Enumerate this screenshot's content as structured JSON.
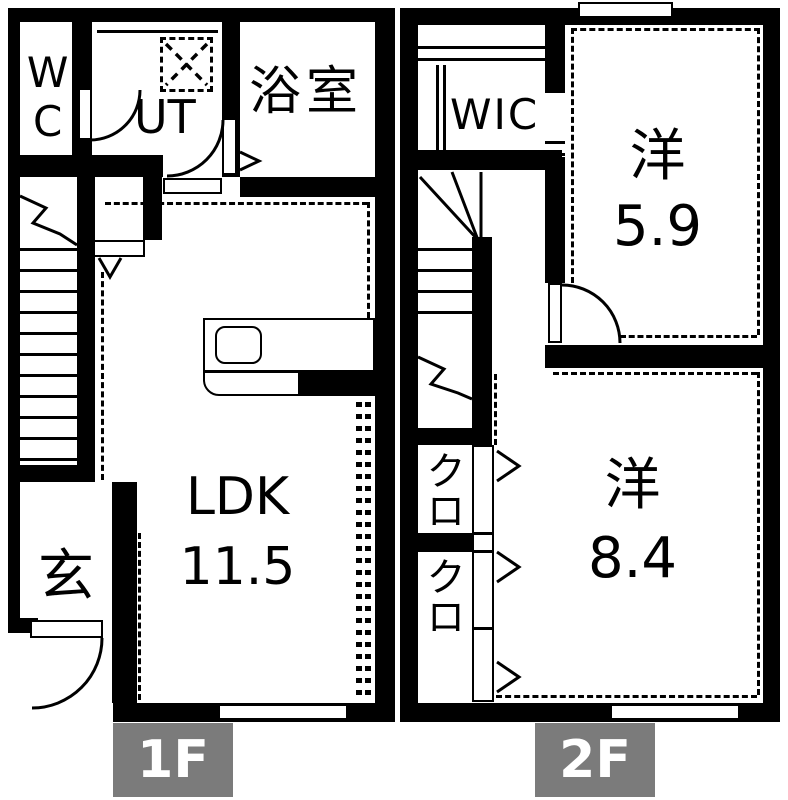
{
  "title": "2-story apartment floor plan",
  "colors": {
    "wall": "#000000",
    "bg": "#ffffff",
    "badge_bg": "#7b7b7b",
    "badge_text": "#ffffff",
    "line": "#000000"
  },
  "floor1": {
    "badge": "1F",
    "wc": "WC",
    "ut": "UT",
    "bath": "浴室",
    "ldk_name": "LDK",
    "ldk_size": "11.5",
    "entrance": "玄"
  },
  "floor2": {
    "badge": "2F",
    "wic": "WIC",
    "room1_name": "洋",
    "room1_size": "5.9",
    "room2_name": "洋",
    "room2_size": "8.4",
    "closet1": "クロ",
    "closet2": "クロ"
  }
}
